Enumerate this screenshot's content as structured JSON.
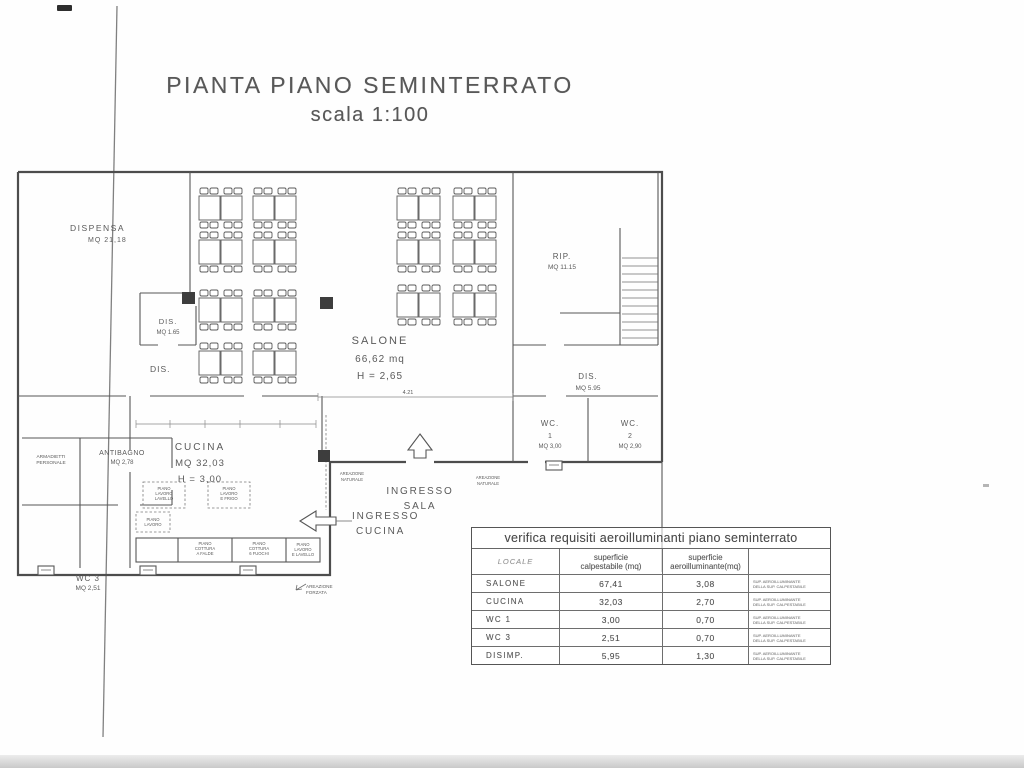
{
  "page": {
    "title": "PIANTA PIANO SEMINTERRATO",
    "subtitle": "scala 1:100"
  },
  "rooms": {
    "dispensa": {
      "name": "DISPENSA",
      "area": "MQ 21,18"
    },
    "salone": {
      "name": "SALONE",
      "area": "66,62 mq",
      "height": "H = 2,65"
    },
    "rip": {
      "name": "RIP.",
      "area": "MQ 11.15"
    },
    "dis1": {
      "name": "DIS.",
      "area": "MQ 1.65"
    },
    "dis2": {
      "name": "DIS."
    },
    "dis3": {
      "name": "DIS.",
      "area": "MQ 5.95"
    },
    "wc1": {
      "name": "WC.",
      "num": "1",
      "area": "MQ 3,00"
    },
    "wc2": {
      "name": "WC.",
      "num": "2",
      "area": "MQ 2,90"
    },
    "antibagno": {
      "name": "ANTIBAGNO",
      "area": "MQ 2,78"
    },
    "armadietti": {
      "line1": "ARMADIETTI",
      "line2": "PERSONALE"
    },
    "wc3": {
      "name": "WC 3",
      "area": "MQ 2,51"
    },
    "cucina": {
      "name": "CUCINA",
      "area": "MQ 32,03",
      "height": "H = 3,00"
    }
  },
  "plan_labels": {
    "ingresso_sala": [
      "INGRESSO",
      "SALA"
    ],
    "ingresso_cucina": [
      "INGRESSO",
      "CUCINA"
    ],
    "areazione_forzata": [
      "AREAZIONE",
      "FORZATA"
    ],
    "areazione_nat1": [
      "AREAZIONE",
      "NATURALE"
    ],
    "areazione_nat2": [
      "AREAZIONE",
      "NATURALE"
    ],
    "dim_salone": "4.21",
    "c1": [
      "PIANO",
      "LAVORO",
      "LAVELLO"
    ],
    "c2": [
      "PIANO",
      "LAVORO",
      "E FRIGO"
    ],
    "c3": [
      "PIANO",
      "LAVORO"
    ],
    "c4": [
      "PIANO",
      "COTTURA",
      "A FALDE"
    ],
    "c5": [
      "PIANO",
      "COTTURA",
      "6 FUOCHI"
    ],
    "c6": [
      "PIANO",
      "LAVORO",
      "E LAVELLO"
    ]
  },
  "verifica": {
    "title": "verifica requisiti aeroilluminanti piano seminterrato",
    "col_locale": "LOCALE",
    "col_calp": [
      "superficie",
      "calpestabile (mq)"
    ],
    "col_aero": [
      "superficie",
      "aeroilluminante(mq)"
    ],
    "note": [
      "SUP. AEROILLUMINANTE",
      "DELLA SUP. CALPESTABILE"
    ],
    "rows": [
      {
        "locale": "SALONE",
        "calp": "67,41",
        "aero": "3,08"
      },
      {
        "locale": "CUCINA",
        "calp": "32,03",
        "aero": "2,70"
      },
      {
        "locale": "WC 1",
        "calp": "3,00",
        "aero": "0,70"
      },
      {
        "locale": "WC 3",
        "calp": "2,51",
        "aero": "0,70"
      },
      {
        "locale": "DISIMP.",
        "calp": "5,95",
        "aero": "1,30"
      }
    ]
  }
}
